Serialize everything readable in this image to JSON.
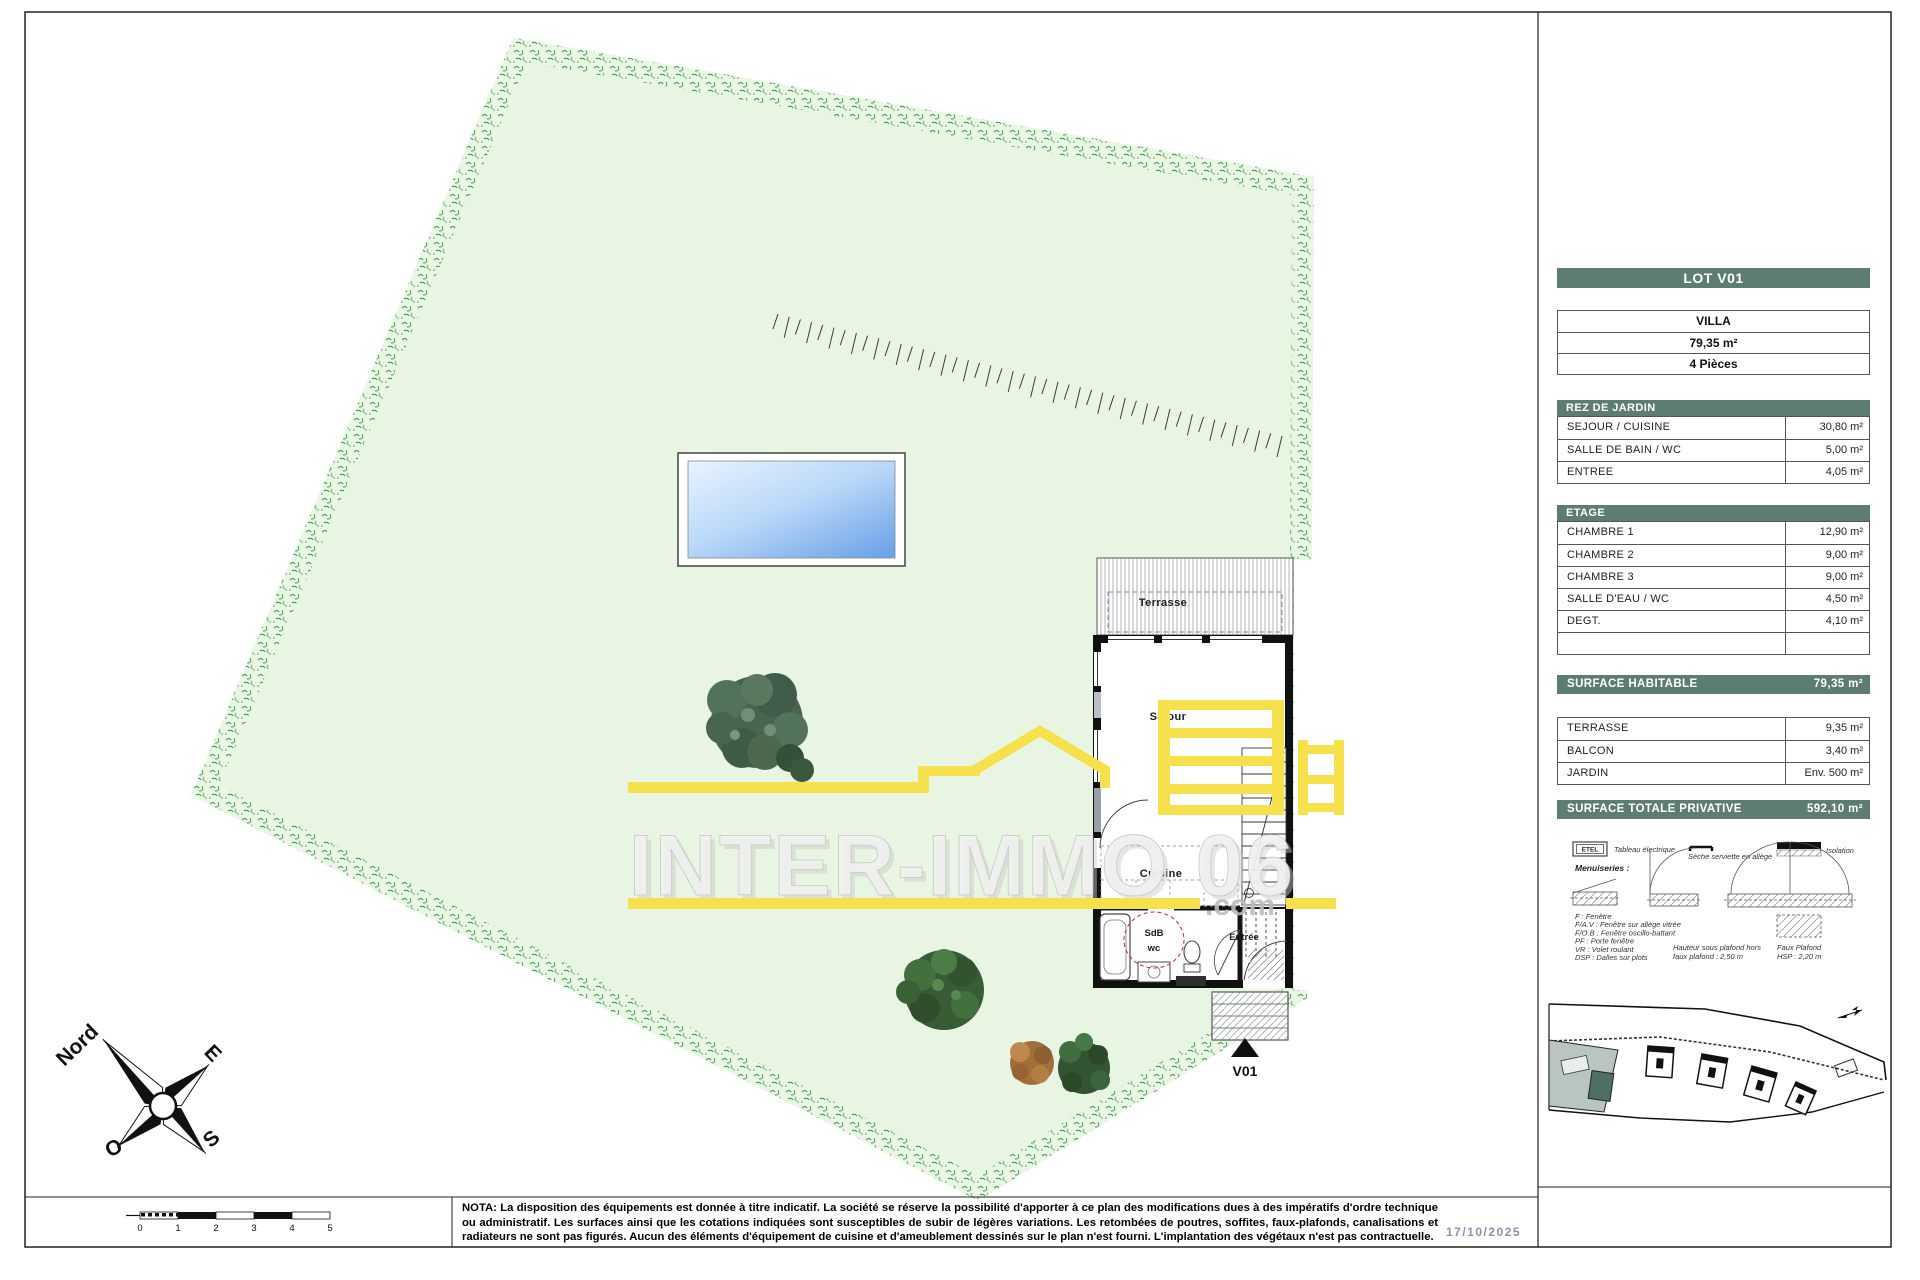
{
  "sheet": {
    "date": "17/10/2025",
    "nota": "NOTA: La disposition des équipements est donnée à titre indicatif. La société se réserve la possibilité d'apporter à ce plan des modifications dues à des impératifs d'ordre technique ou administratif. Les surfaces ainsi que les cotations indiquées sont susceptibles de subir de légères variations. Les retombées de poutres, soffites, faux-plafonds, canalisations et radiateurs ne sont pas figurés. Aucun des éléments d'équipement de cuisine et d'ameublement dessinés sur le plan n'est fourni. L'implantation des végétaux n'est pas contractuelle."
  },
  "watermark": {
    "text": "INTER-IMMO 06",
    "domain": ".com"
  },
  "compass": {
    "north": "Nord",
    "east": "E",
    "south": "S",
    "west": "O"
  },
  "scalebar": {
    "labels": [
      "0",
      "1",
      "2",
      "3",
      "4",
      "5"
    ]
  },
  "plan": {
    "labels": {
      "terrasse": "Terrasse",
      "sejour": "Séjour",
      "cuisine": "Cuisine",
      "sdb": "SdB",
      "wc": "wc",
      "entree": "Entrée",
      "lot_marker": "V01"
    }
  },
  "lot_panel": {
    "title": "LOT V01",
    "summary": [
      "VILLA",
      "79,35 m²",
      "4 Pièces"
    ],
    "sections": [
      {
        "title": "REZ DE JARDIN",
        "rows": [
          [
            "SEJOUR / CUISINE",
            "30,80 m²"
          ],
          [
            "SALLE DE BAIN / WC",
            "5,00 m²"
          ],
          [
            "ENTREE",
            "4,05 m²"
          ]
        ]
      },
      {
        "title": "ETAGE",
        "rows": [
          [
            "CHAMBRE 1",
            "12,90 m²"
          ],
          [
            "CHAMBRE 2",
            "9,00 m²"
          ],
          [
            "CHAMBRE 3",
            "9,00 m²"
          ],
          [
            "SALLE D'EAU / WC",
            "4,50 m²"
          ],
          [
            "DEGT.",
            "4,10 m²"
          ],
          [
            "",
            ""
          ]
        ]
      }
    ],
    "surface_habitable": {
      "label": "SURFACE HABITABLE",
      "value": "79,35 m²"
    },
    "annex_rows": [
      [
        "TERRASSE",
        "9,35 m²"
      ],
      [
        "BALCON",
        "3,40 m²"
      ],
      [
        "JARDIN",
        "Env. 500 m²"
      ]
    ],
    "surface_totale": {
      "label": "SURFACE TOTALE PRIVATIVE",
      "value": "592,10 m²"
    }
  },
  "legend": {
    "etel": "ETEL",
    "tableau_electrique": "Tableau électrique",
    "seche_serviette": "Sèche serviette en allège",
    "isolation": "Isolation",
    "menuiseries": "Menuiseries :",
    "abbreviations": [
      "F : Fenêtre",
      "F/A.V : Fenêtre sur allège vitrée",
      "F/O.B : Fenêtre oscillo-battant",
      "PF : Porte fenêtre",
      "VR : Volet roulant",
      "DSP : Dalles sur plots"
    ],
    "hsp": [
      "Hauteur sous plafond hors",
      "faux plafond : 2,50 m"
    ],
    "faux_plafond": [
      "Faux Plafond",
      "HSP : 2,20 m"
    ]
  },
  "colors": {
    "accent_teal": "#5d7d73",
    "logo_yellow": "#f6e04b",
    "plot_green": "#e7f5e2",
    "pool_blue": "#6ea4e8",
    "date_gray": "#8795aa"
  }
}
